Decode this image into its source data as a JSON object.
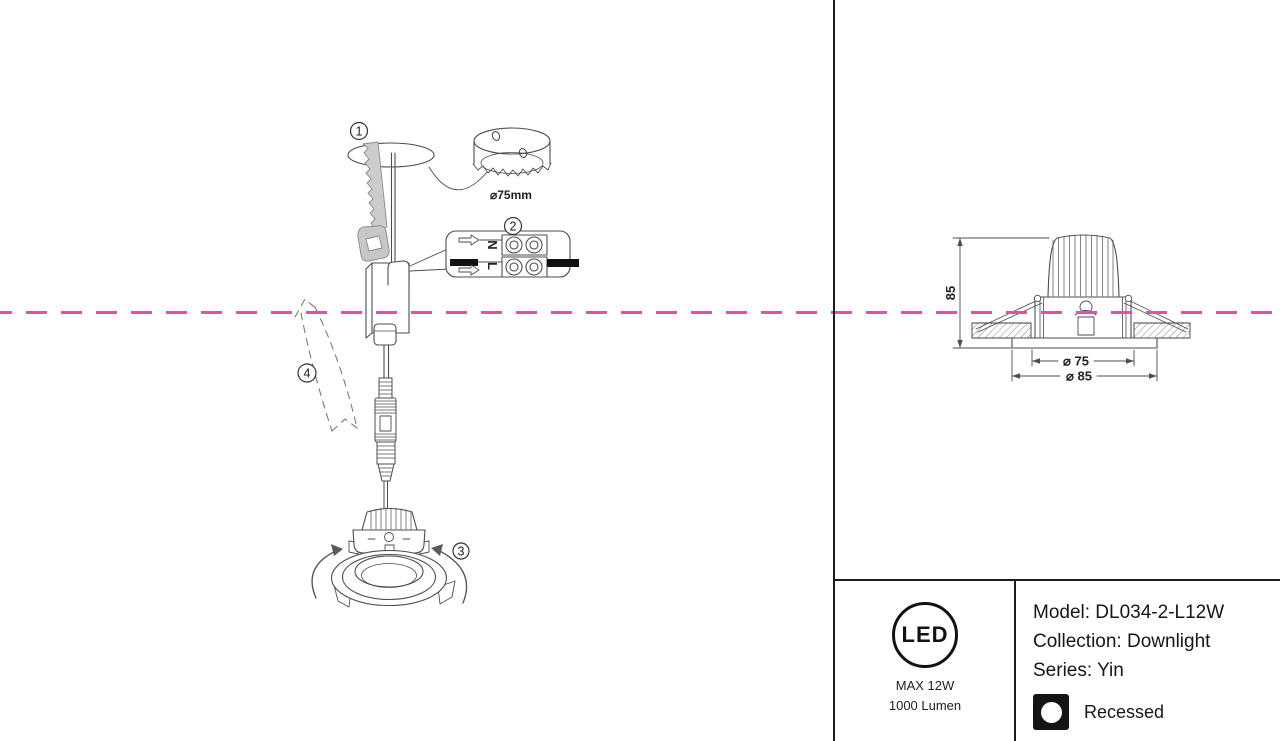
{
  "colors": {
    "background": "#ffffff",
    "drawing_line": "#4d4d4d",
    "border_line": "#1c1c1c",
    "centerline_magenta": "#e84fa0",
    "saw_fill": "#cccccc",
    "wire_black": "#111111"
  },
  "installation": {
    "steps": [
      {
        "number": "1"
      },
      {
        "number": "2"
      },
      {
        "number": "3"
      },
      {
        "number": "4"
      }
    ],
    "hole_saw_label": "⌀75mm",
    "connector": {
      "neutral": "N",
      "live": "L"
    }
  },
  "dimension_drawing": {
    "height_mm": "85",
    "cutout_diameter": "⌀ 75",
    "overall_diameter": "⌀ 85"
  },
  "title_block": {
    "led_logo_text": "LED",
    "max_power": "MAX 12W",
    "luminous_flux": "1000 Lumen",
    "model": "Model: DL034-2-L12W",
    "collection": "Collection: Downlight",
    "series": "Series: Yin",
    "mounting": "Recessed"
  }
}
